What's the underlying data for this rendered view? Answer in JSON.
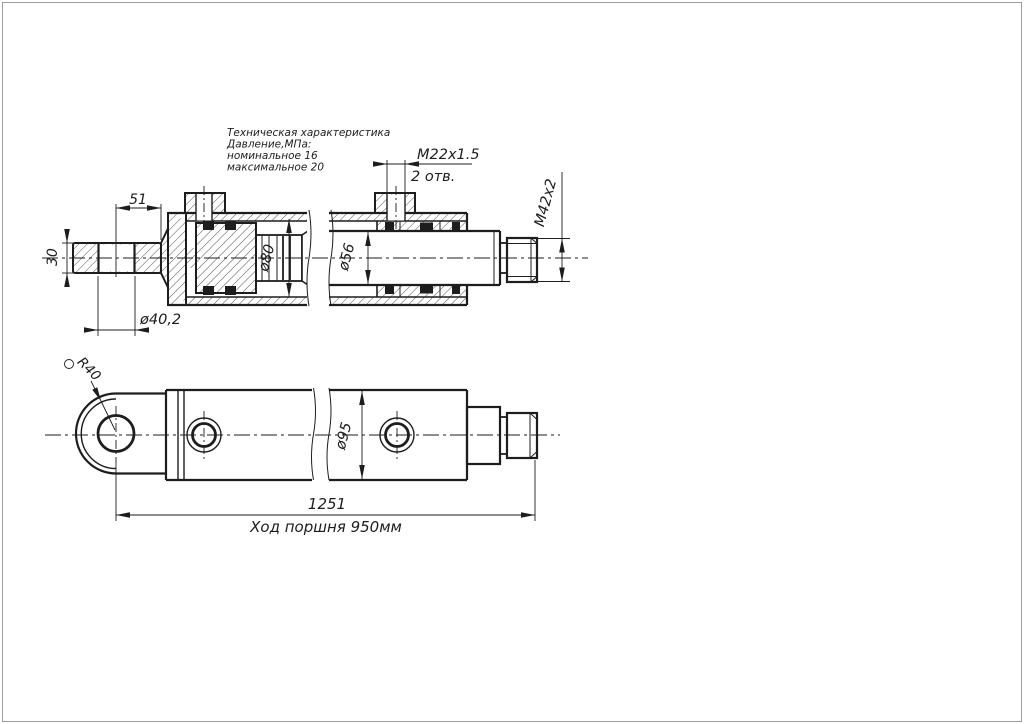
{
  "drawing": {
    "title_block": {
      "line1": "Техническая характеристика",
      "line2": "Давление,МПа:",
      "line3": "номинальное 16",
      "line4": "максимальное 20"
    },
    "labels": {
      "port_thread": "М22х1.5",
      "port_count": "2 отв.",
      "pin_offset": "51",
      "pin_width": "30",
      "pin_bore": "ø40,2",
      "cylinder_bore": "ø80",
      "rod_diameter": "ø56",
      "rod_thread": "М42х2",
      "outer_diameter": "ø95",
      "eye_radius": "R40",
      "overall_length": "1251",
      "piston_stroke": "Ход поршня 950мм"
    },
    "colors": {
      "line": "#1d1d1d",
      "frame": "#9e9e9e",
      "background": "#ffffff"
    }
  }
}
